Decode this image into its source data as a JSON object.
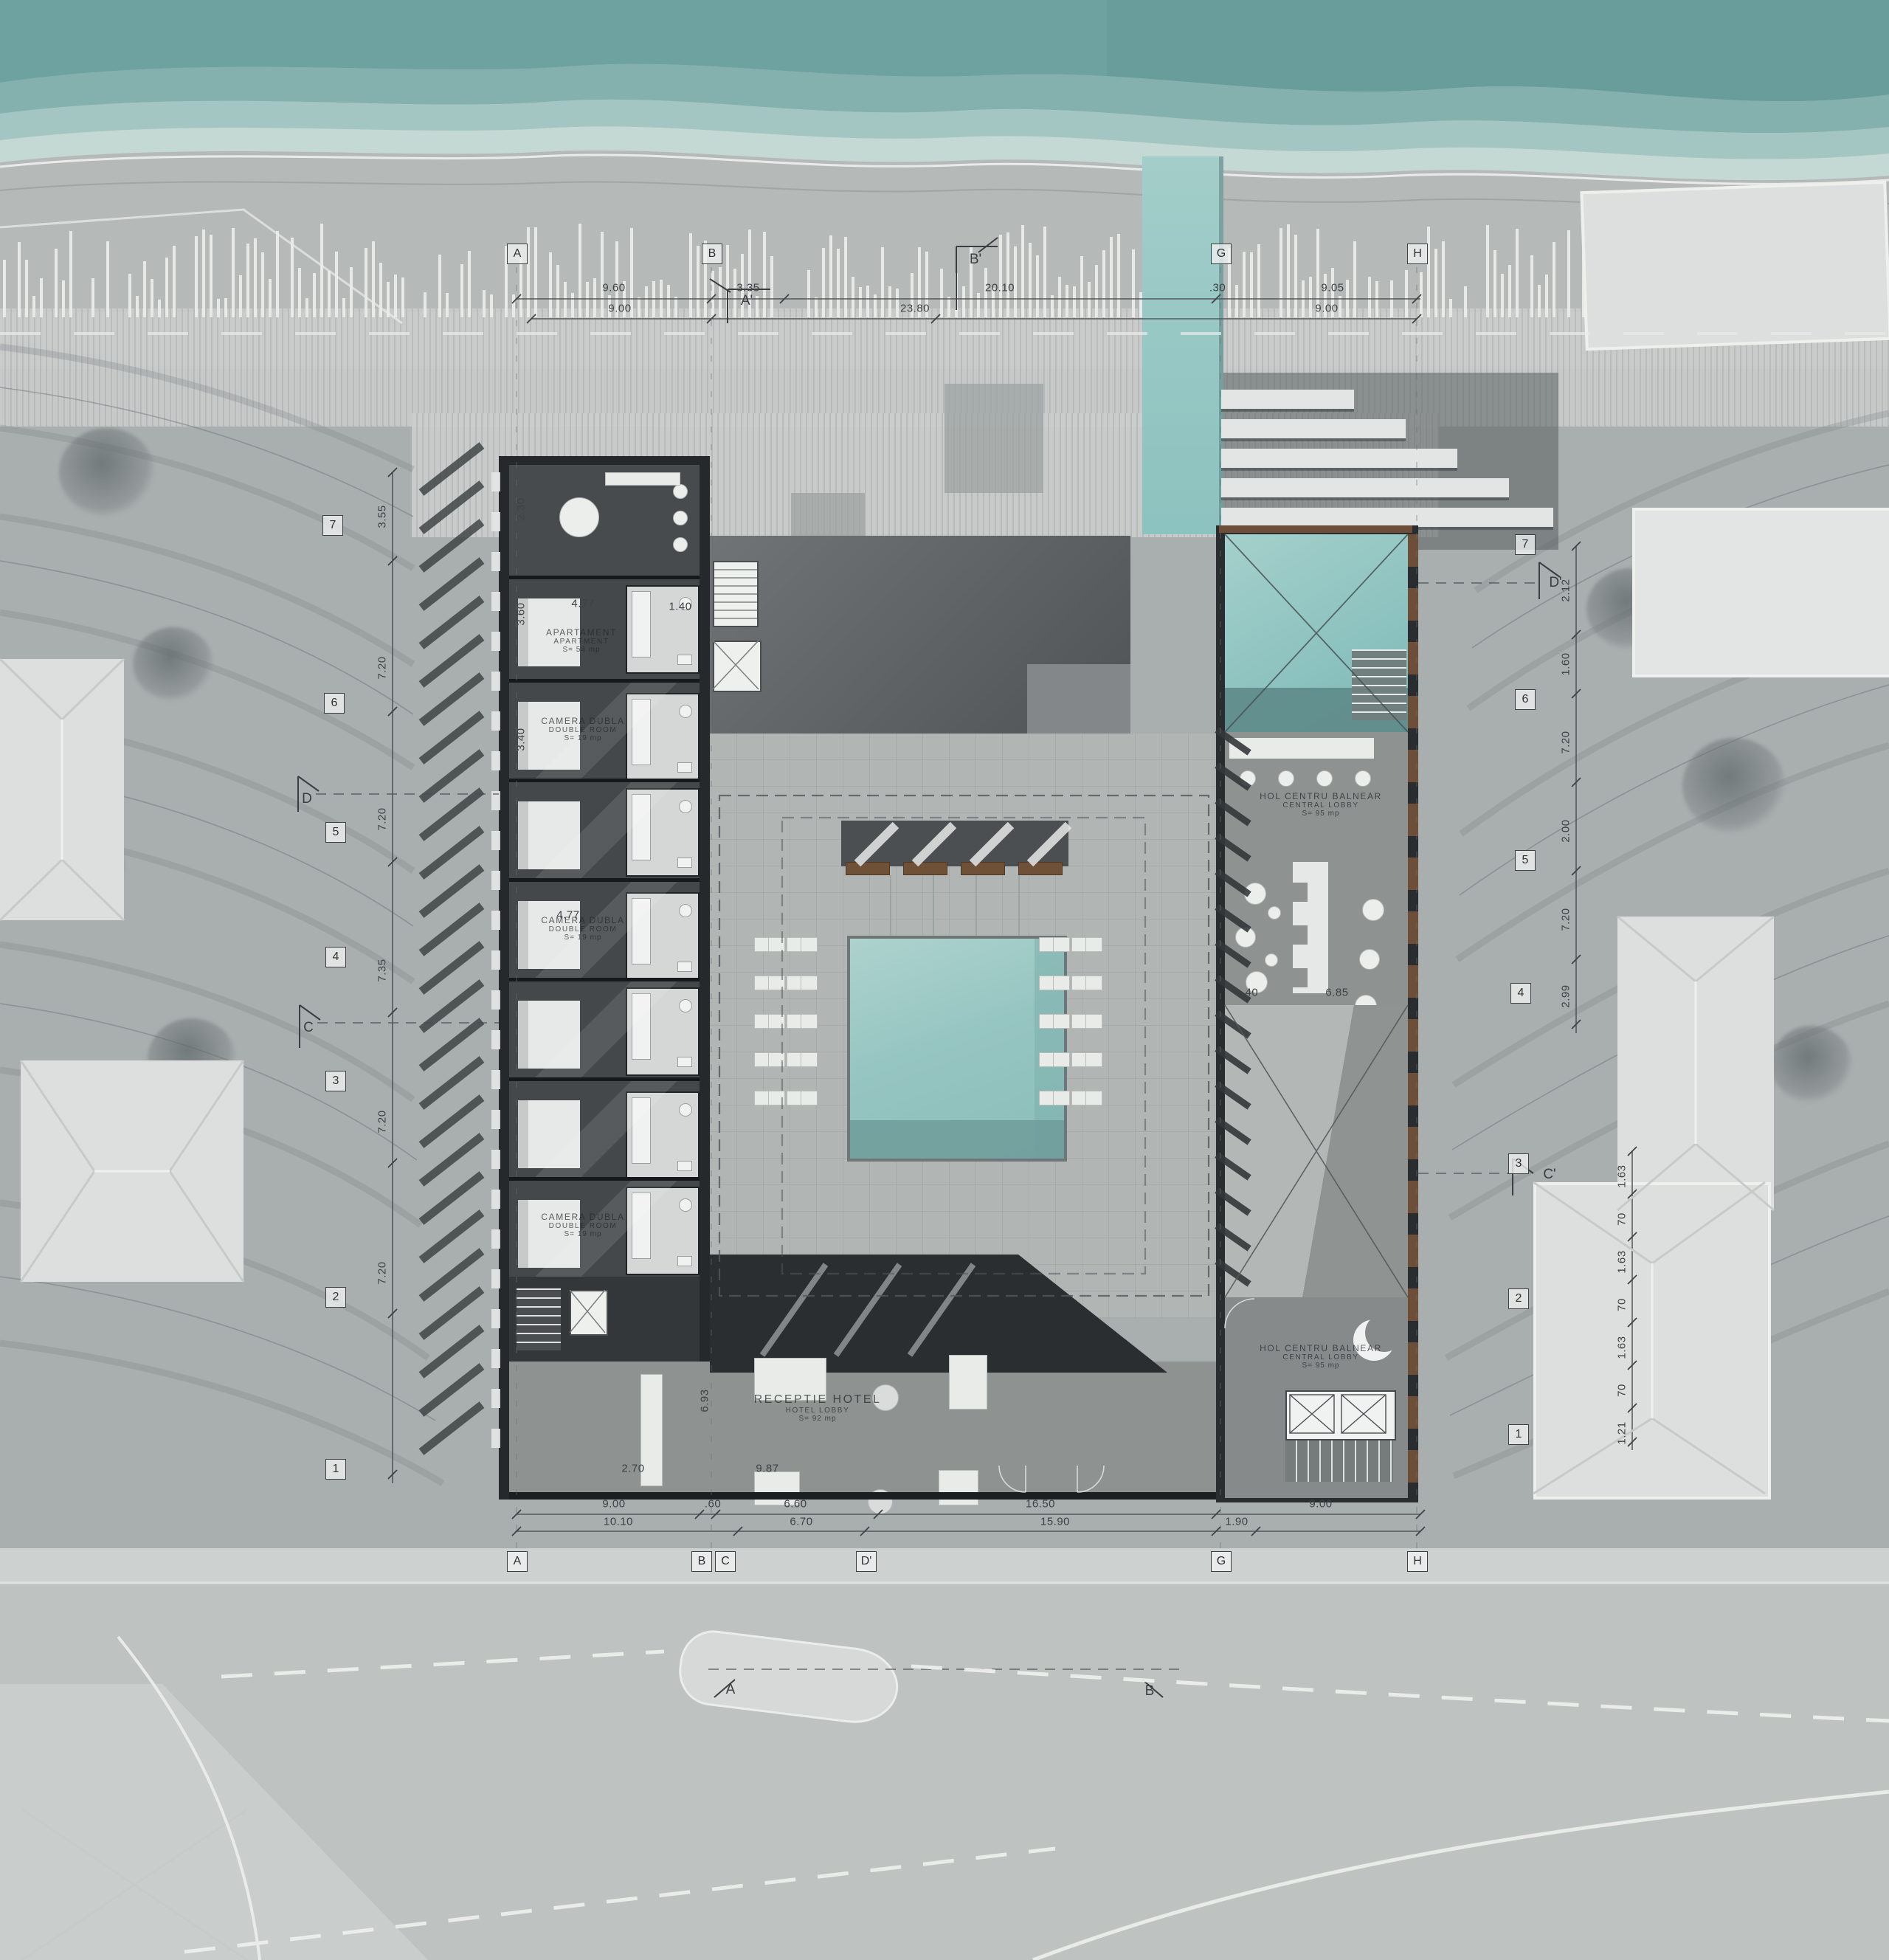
{
  "palette": {
    "sea": "#6da2a1",
    "pool": "#93c4c0",
    "wood": "#6d4f39",
    "wall": "#232628",
    "site": "#a9aeae"
  },
  "grid": {
    "top": [
      "A",
      "B",
      "G",
      "H"
    ],
    "bottom": [
      "A",
      "B",
      "C",
      "D'",
      "G",
      "H"
    ],
    "left": [
      "7",
      "6",
      "5",
      "4",
      "3",
      "2",
      "1"
    ],
    "right": [
      "7",
      "6",
      "5",
      "4",
      "3",
      "2",
      "1"
    ]
  },
  "section_markers": {
    "a_prime": "A'",
    "b_prime": "B'",
    "c": "C",
    "d": "D",
    "c_prime": "C'",
    "d_prime": "D'",
    "a": "A",
    "b": "B"
  },
  "dimensions": {
    "top_row1": [
      "9.60",
      "3.35",
      "20.10",
      ".30",
      "9.05"
    ],
    "top_row2": [
      "9.00",
      "23.80",
      "9.00"
    ],
    "bottom_row1": [
      "9.00",
      ".60",
      "6.60",
      "16.50",
      "9.00"
    ],
    "bottom_row2": [
      "10.10",
      "6.70",
      "15.90",
      "1.90"
    ],
    "left_chain": [
      "3.55",
      "7.20",
      "7.20",
      "7.35",
      "7.20",
      "7.20"
    ],
    "right_upper": [
      "2.12",
      "1.60",
      "7.20",
      "2.00",
      "7.20",
      "2.99"
    ],
    "right_lower": [
      "1.63",
      "70",
      "1.63",
      "70",
      "1.63",
      "70",
      "1.21"
    ],
    "interior": {
      "d230": "2.30",
      "d360": "3.60",
      "d477a": "4.77",
      "d477b": "4.77",
      "d340": "3.40",
      "d140": "1.40",
      "d693": "6.93",
      "d270": "2.70",
      "d987": "9.87",
      "d685": "6.85",
      "d40": ".40"
    }
  },
  "rooms": {
    "apartament": {
      "name": "APARTAMENT",
      "name_en": "APARTMENT",
      "area": "S= 54 mp"
    },
    "camera_dubla": {
      "name": "CAMERA DUBLA",
      "name_en": "DOUBLE ROOM",
      "area": "S= 19 mp"
    },
    "receptie": {
      "name": "RECEPTIE HOTEL",
      "name_en": "HOTEL LOBBY",
      "area": "S= 92 mp"
    },
    "hol_centru": {
      "name": "HOL CENTRU BALNEAR",
      "name_en": "CENTRAL LOBBY",
      "area": "S= 95 mp"
    }
  }
}
